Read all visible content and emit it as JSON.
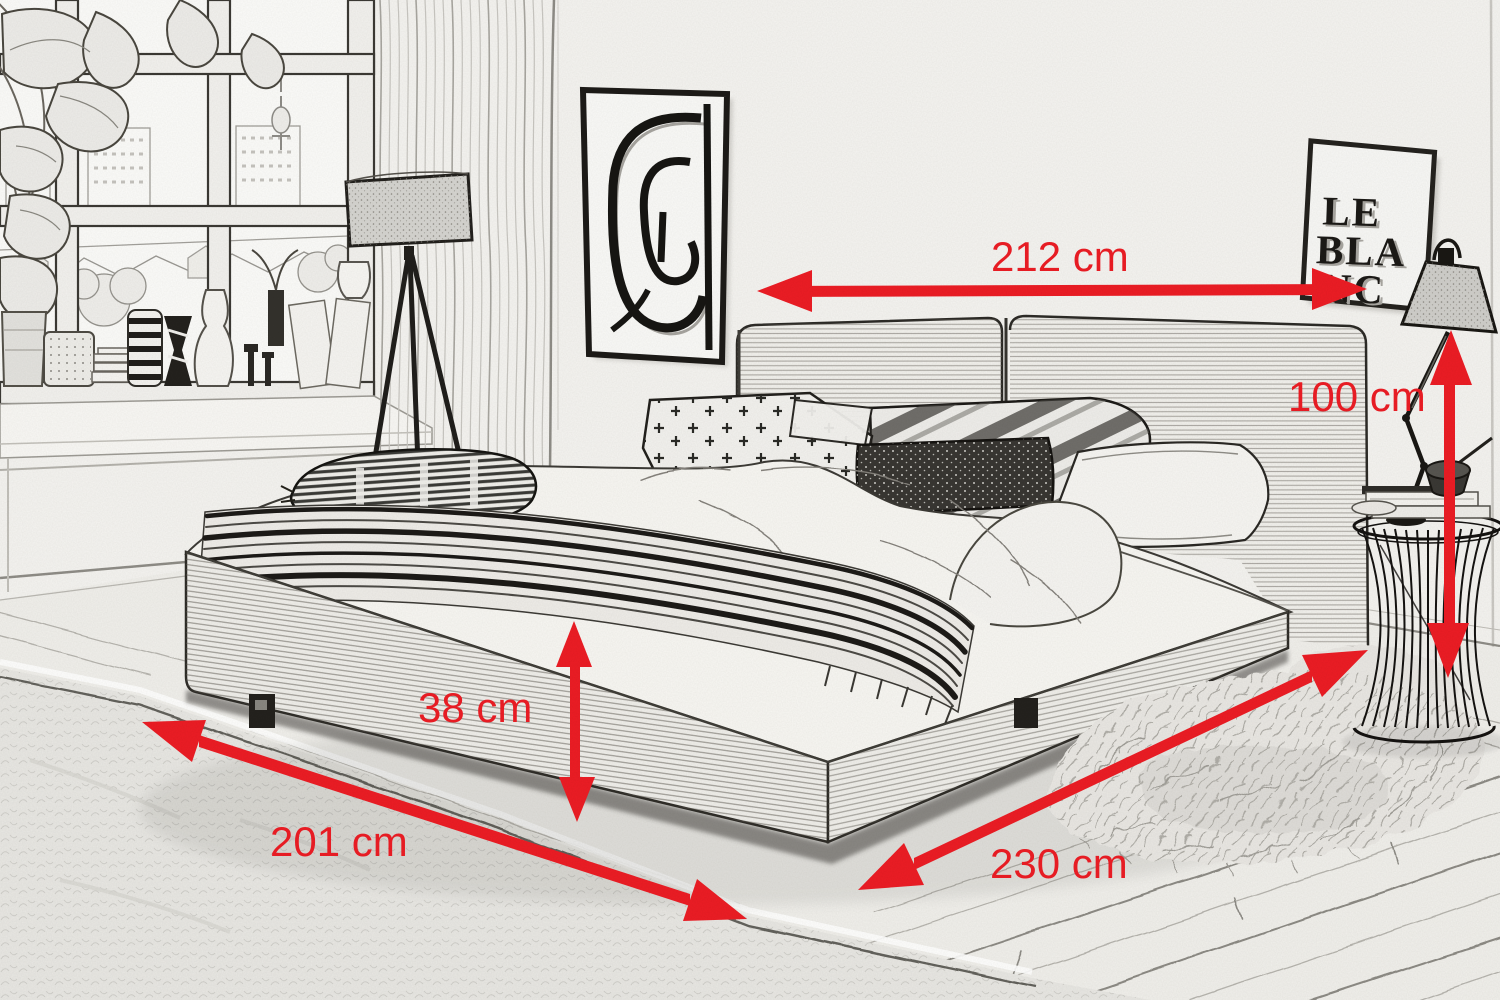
{
  "dimensions": {
    "width": "212 cm",
    "height": "100 cm",
    "base_height": "38 cm",
    "length": "201 cm",
    "depth": "230 cm"
  },
  "poster": {
    "line1": "LE",
    "line2": "BLA",
    "line3": "NC"
  },
  "colors": {
    "dimension_red": "#ed1c24",
    "paper": "#f5f4f1",
    "ink": "#2e2c28"
  }
}
